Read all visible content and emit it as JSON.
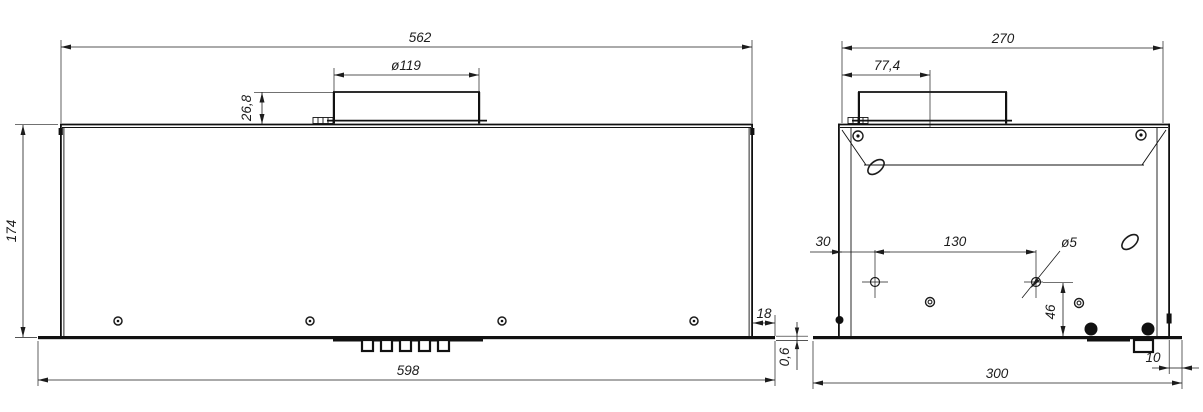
{
  "drawing": {
    "type": "technical-drawing",
    "views": {
      "front_view": {
        "dims": {
          "top_width": "562",
          "duct_diameter": "ø119",
          "collar_height": "26,8",
          "body_height": "174",
          "bottom_width": "598",
          "right_overhang": "18",
          "panel_thickness": "0,6"
        }
      },
      "side_view": {
        "dims": {
          "top_width": "270",
          "collar_offset": "77,4",
          "hole_edge_offset": "30",
          "hole_spacing": "130",
          "hole_diameter": "ø5",
          "hole_height": "46",
          "right_overhang": "10",
          "bottom_width": "300"
        }
      }
    },
    "colors": {
      "line": "#1c1c1c",
      "background": "#ffffff"
    }
  }
}
